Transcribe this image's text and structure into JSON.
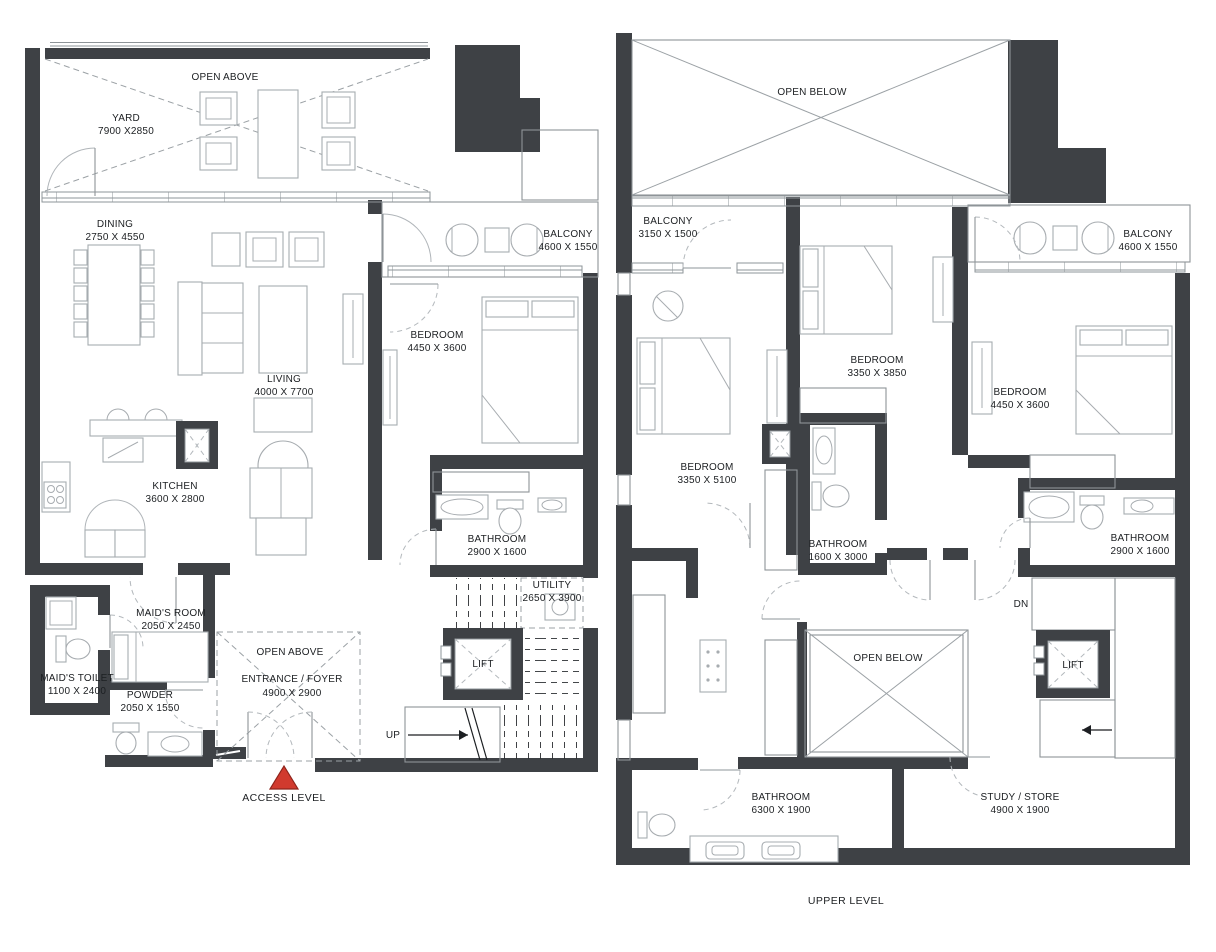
{
  "colors": {
    "wall": "#3E4145",
    "furniture_line": "#A7ACB0",
    "thin_line": "#8E9498",
    "dashed_line": "#9BA1A5",
    "text": "#1C1F22",
    "marker_red": "#D13A2E",
    "background": "#FFFFFF"
  },
  "access": {
    "caption": "ACCESS LEVEL",
    "open_above_yard": {
      "label": "OPEN ABOVE"
    },
    "yard": {
      "label": "YARD",
      "dims": "7900 X2850"
    },
    "dining": {
      "label": "DINING",
      "dims": "2750 X 4550"
    },
    "living": {
      "label": "LIVING",
      "dims": "4000 X 7700"
    },
    "balcony": {
      "label": "BALCONY",
      "dims": "4600 X 1550"
    },
    "bedroom": {
      "label": "BEDROOM",
      "dims": "4450 X 3600"
    },
    "kitchen": {
      "label": "KITCHEN",
      "dims": "3600 X 2800"
    },
    "bathroom": {
      "label": "BATHROOM",
      "dims": "2900 X 1600"
    },
    "utility": {
      "label": "UTILITY",
      "dims": "2650 X 3900"
    },
    "lift": {
      "label": "LIFT"
    },
    "maids_room": {
      "label": "MAID'S ROOM",
      "dims": "2050 X 2450"
    },
    "maids_toilet": {
      "label": "MAID'S TOILET",
      "dims": "1100 X 2400"
    },
    "powder": {
      "label": "POWDER",
      "dims": "2050 X 1550"
    },
    "entrance_open": {
      "label": "OPEN ABOVE"
    },
    "entrance": {
      "label": "ENTRANCE / FOYER",
      "dims": "4900 X 2900"
    },
    "stairs": {
      "label": "UP"
    }
  },
  "upper": {
    "caption": "UPPER LEVEL",
    "open_below_top": {
      "label": "OPEN BELOW"
    },
    "balcony_left": {
      "label": "BALCONY",
      "dims": "3150 X 1500"
    },
    "bedroom_left": {
      "label": "BEDROOM",
      "dims": "3350 X 5100"
    },
    "bedroom_mid": {
      "label": "BEDROOM",
      "dims": "3350 X 3850"
    },
    "bedroom_right": {
      "label": "BEDROOM",
      "dims": "4450 X 3600"
    },
    "balcony_right": {
      "label": "BALCONY",
      "dims": "4600 X 1550"
    },
    "bathroom_mid": {
      "label": "BATHROOM",
      "dims": "1600 X 3000"
    },
    "bathroom_right": {
      "label": "BATHROOM",
      "dims": "2900 X 1600"
    },
    "bathroom_bottom": {
      "label": "BATHROOM",
      "dims": "6300 X 1900"
    },
    "study": {
      "label": "STUDY / STORE",
      "dims": "4900 X 1900"
    },
    "lift": {
      "label": "LIFT"
    },
    "open_below_mid": {
      "label": "OPEN BELOW"
    },
    "stairs": {
      "label": "DN"
    }
  }
}
